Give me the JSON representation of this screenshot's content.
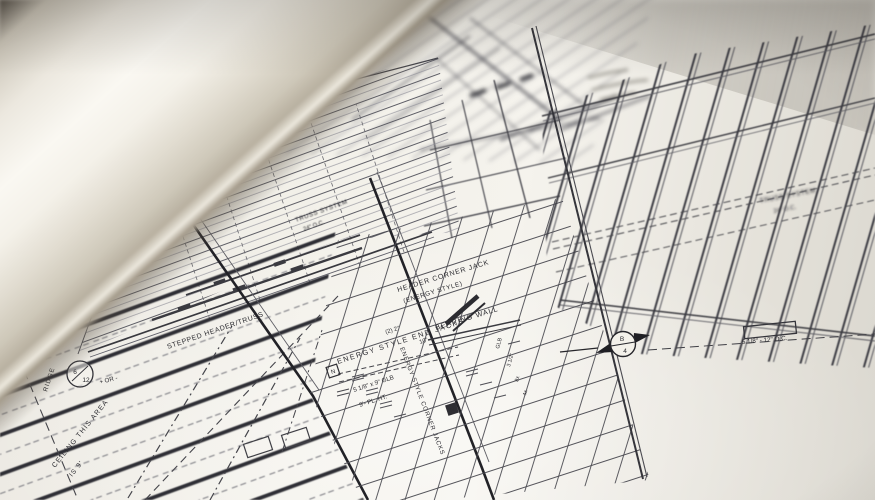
{
  "colors": {
    "paper": "#f3f1ea",
    "ink": "#2c2c31",
    "ink_light": "#5d5d64",
    "table_dark": "#46423b",
    "page_roll_highlight": "#faf8f2"
  },
  "drawing": {
    "labels": {
      "ridge": "RIDGE",
      "pitch_numerator": "6",
      "pitch_denominator": "12",
      "pitch_suffix": "+ OR -",
      "stepped_header": "STEPPED HEADER/TRUSS",
      "ceiling_line1": "CEILING THIS AREA",
      "ceiling_line2": "IS 9'",
      "truss_center_line1": "TRUSS SYSTEM",
      "truss_center_line2": "24\" O.C.",
      "truss_right_line1": "TRUSS SYSTEM",
      "truss_right_line2": "24\" O.C.",
      "header_jack_line1": "HEADER CORNER JACK",
      "header_jack_line2": "(ENERGY STYLE)",
      "bearing_wall": "BEARING WALL",
      "end_jacks": "ENERGY STYLE END JACKS",
      "corner_jacks": "ENERGY STYLE CORNER JACKS",
      "pair_note": "(2) 2\"",
      "size_note": "10\"",
      "glb_note": "5 1/8\" x 9\" GLB",
      "plate_height": "9'- PL. HT.",
      "spacing_note": "5 1/8\" - 12\" O.C.",
      "section_letter": "B",
      "section_number": "4",
      "detail_box_letter": "N",
      "frag_glb": "GLB",
      "frag_dim": "3 1/2\"",
      "frag_8x": "8x",
      "frag_4x": "4x"
    }
  }
}
